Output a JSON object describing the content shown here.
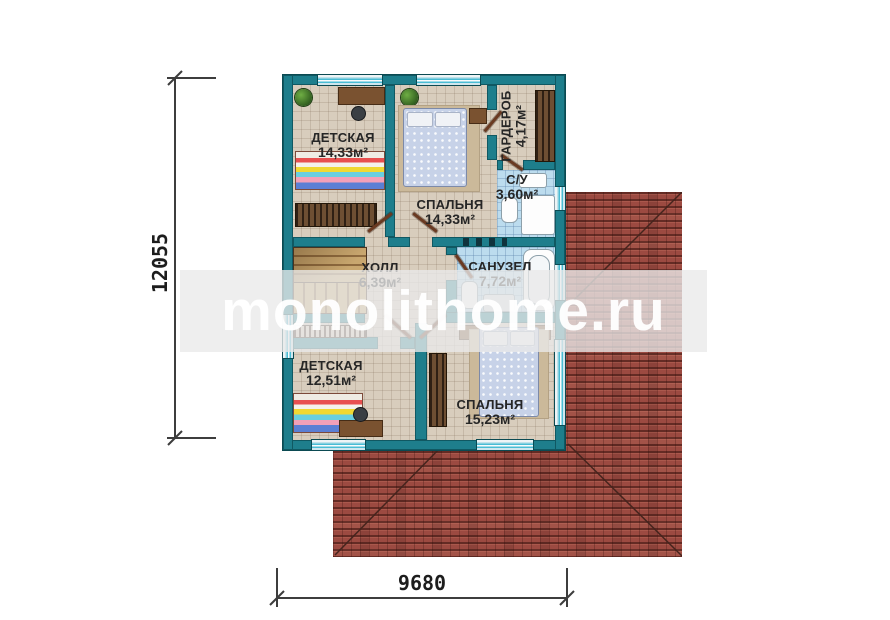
{
  "watermark": {
    "text": "monolithome.ru"
  },
  "dimensions": {
    "vertical": "12055",
    "horizontal": "9680"
  },
  "rooms": [
    {
      "id": "kids-room-top",
      "name": "ДЕТСКАЯ",
      "area": "14,33м²"
    },
    {
      "id": "bedroom-top",
      "name": "СПАЛЬНЯ",
      "area": "14,33м²"
    },
    {
      "id": "wardrobe",
      "name": "ГАРДЕРОБ",
      "area": "4,17м²"
    },
    {
      "id": "wc",
      "name": "С/У",
      "area": "3,60м²"
    },
    {
      "id": "hall",
      "name": "ХОЛЛ",
      "area": "6,39м²"
    },
    {
      "id": "bathroom",
      "name": "САНУЗЕЛ",
      "area": "7,72м²"
    },
    {
      "id": "kids-room-bottom",
      "name": "ДЕТСКАЯ",
      "area": "12,51м²"
    },
    {
      "id": "bedroom-bottom",
      "name": "СПАЛЬНЯ",
      "area": "15,23м²"
    }
  ],
  "colors": {
    "wall_teal": "#1e7e8c",
    "roof_red": "#9c4a41",
    "floor_beige": "#d8cdbd",
    "tile_blue": "#bcdcee",
    "window_blue": "#49bcd4",
    "dimension_line": "#3d3d3d"
  }
}
